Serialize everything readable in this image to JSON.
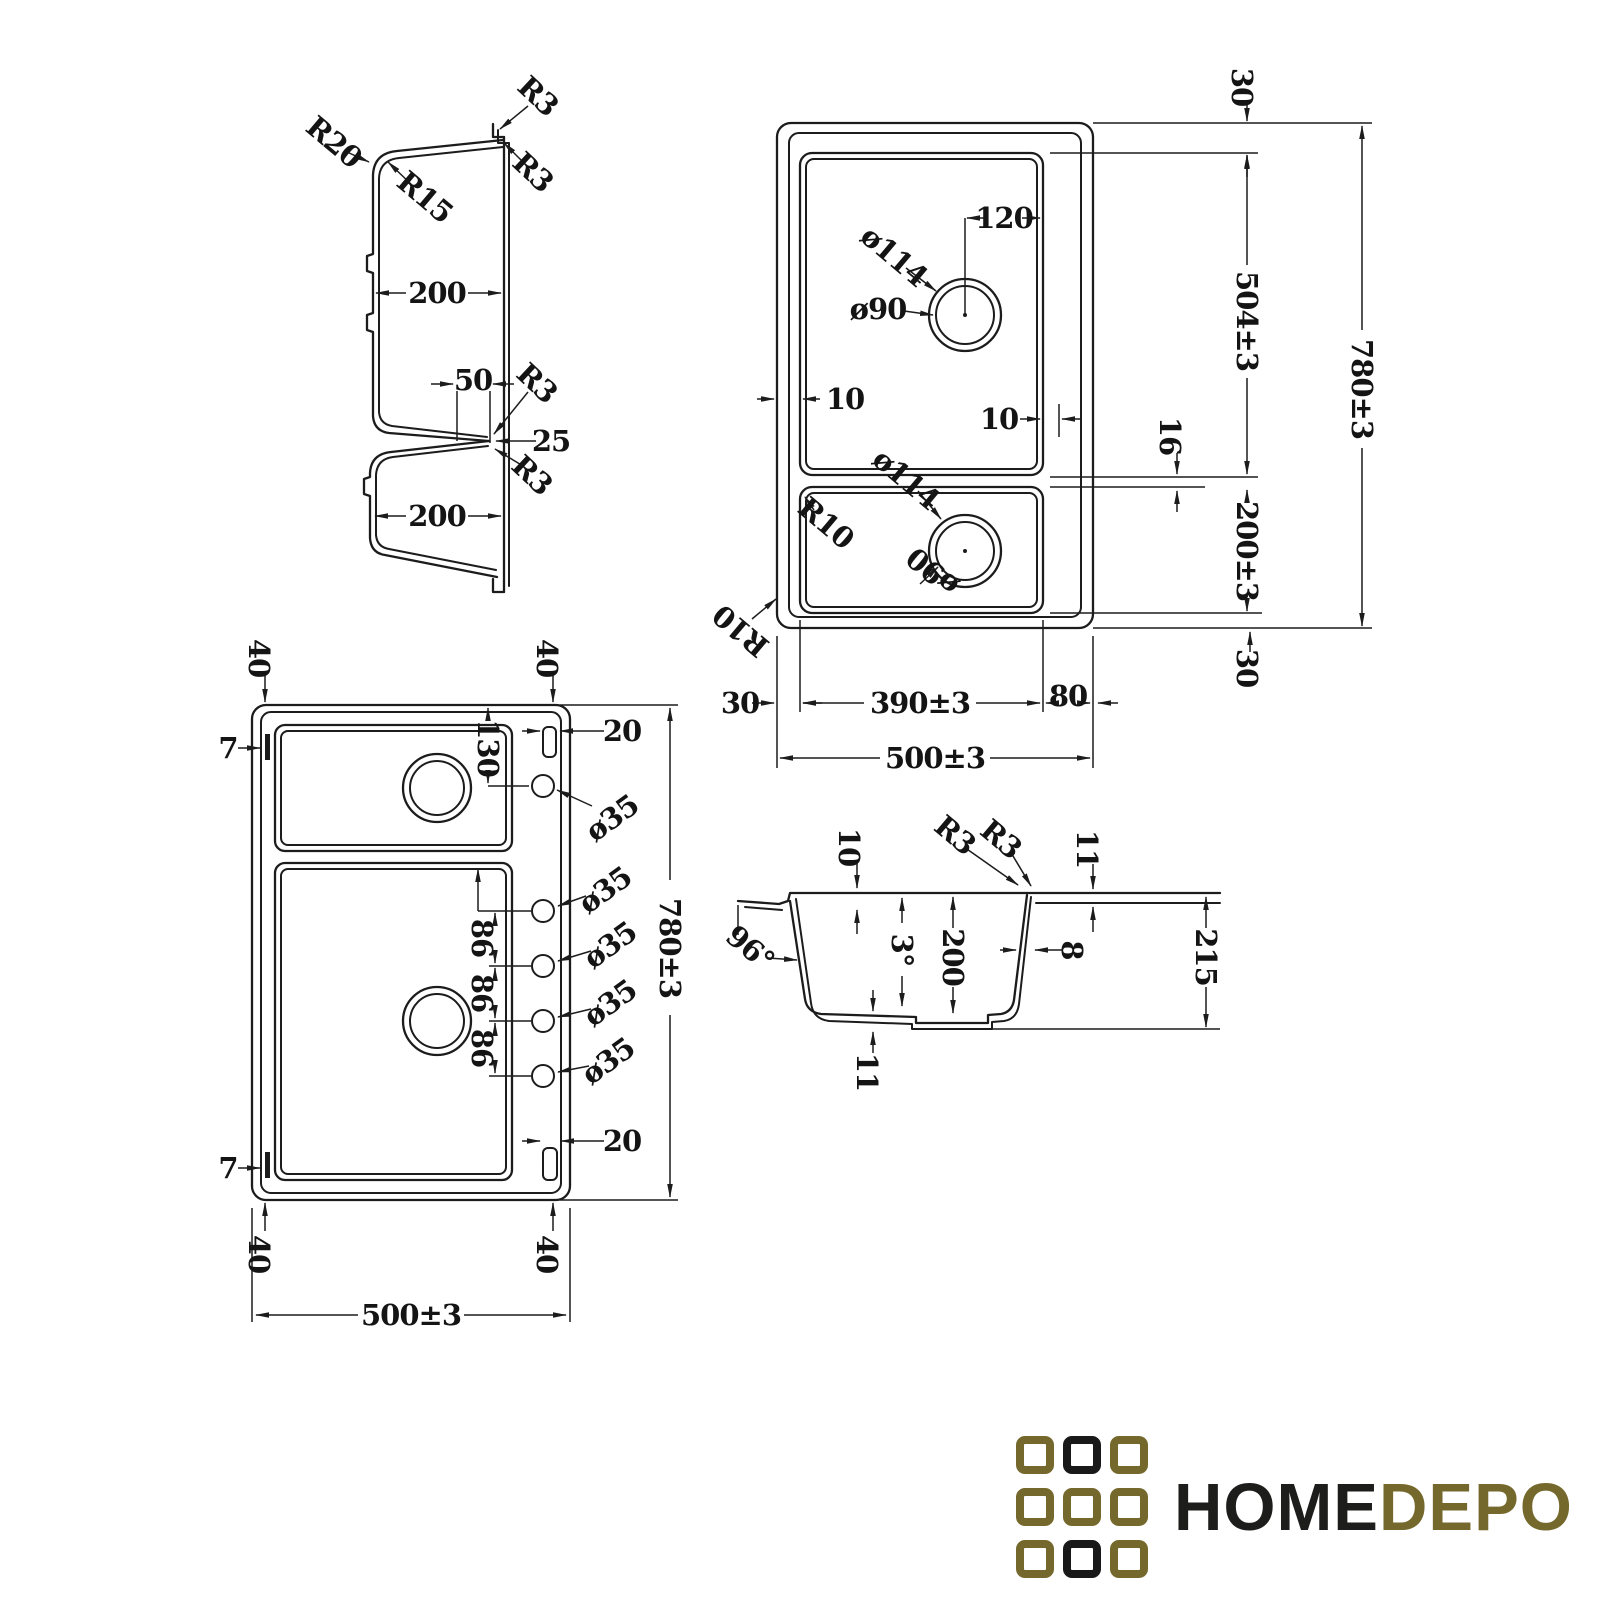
{
  "page": {
    "background": "#ffffff",
    "line_color": "#1c1c1c"
  },
  "logo": {
    "home": "HOME",
    "depo": "DEPO",
    "colors": {
      "gold": "#75682c",
      "black": "#191919"
    },
    "grid": [
      [
        "gold",
        "black",
        "gold"
      ],
      [
        "gold",
        "gold",
        "gold"
      ],
      [
        "gold",
        "black",
        "gold"
      ]
    ]
  },
  "views": {
    "sectionLong": {
      "r20": "R20",
      "r15": "R15",
      "r3_top": "R3",
      "r3_upper": "R3",
      "w200_top": "200",
      "w50": "50",
      "r3_mid": "R3",
      "d25": "25",
      "r3_low": "R3",
      "w200_bot": "200"
    },
    "planTop": {
      "t30_top": "30",
      "d120": "120",
      "dia114_top": "ø114",
      "dia90_top": "ø90",
      "g10_left": "10",
      "g10_right": "10",
      "t16": "16",
      "dia114_bot": "ø114",
      "r10_bowl": "R10",
      "dia90_bot": "ø90",
      "r10_outer": "R10",
      "t30_left": "30",
      "w390": "390±3",
      "w80": "80",
      "w500": "500±3",
      "h504": "504±3",
      "h780": "780±3",
      "h200": "200±3",
      "t30_bot": "30"
    },
    "planBottom": {
      "t40_tl": "40",
      "t40_tr": "40",
      "t7_top": "7",
      "t20_top": "20",
      "d130": "130",
      "dia35_1": "ø35",
      "dia35_2": "ø35",
      "g86_1": "86",
      "dia35_3": "ø35",
      "g86_2": "86",
      "dia35_4": "ø35",
      "g86_3": "86",
      "dia35_5": "ø35",
      "h780": "780±3",
      "t20_bot": "20",
      "t7_bot": "7",
      "t40_bl": "40",
      "t40_br": "40",
      "w500": "500±3"
    },
    "sectionCross": {
      "t10": "10",
      "r3_left": "R3",
      "r3_right": "R3",
      "t11_top": "11",
      "a96": "96°",
      "a3": "3°",
      "d200": "200",
      "t8": "8",
      "d215": "215",
      "t11_bot": "11"
    }
  }
}
